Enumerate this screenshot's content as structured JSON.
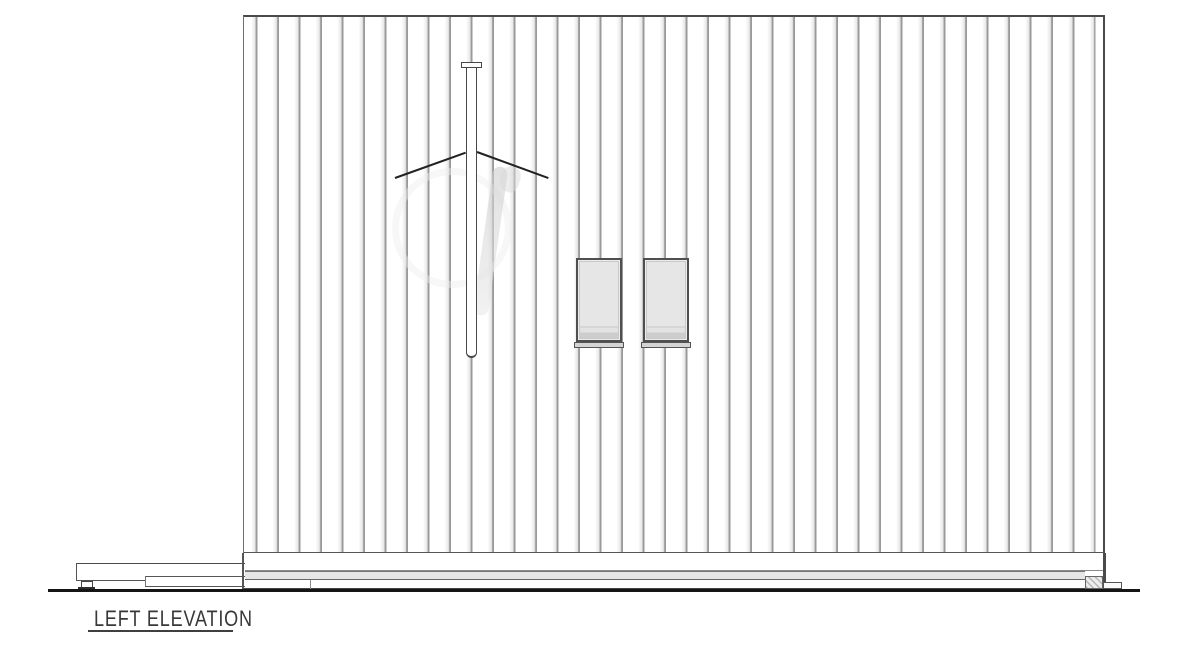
{
  "drawing": {
    "title": "LEFT ELEVATION"
  },
  "colors": {
    "outline": "#4a4a4a",
    "siding_line": "#9a9a9a",
    "window_fill": "#e2e2e2",
    "skirt_fill": "#e6e6e6",
    "ground_line": "#151515",
    "title_text": "#383838",
    "background": "#ffffff"
  }
}
